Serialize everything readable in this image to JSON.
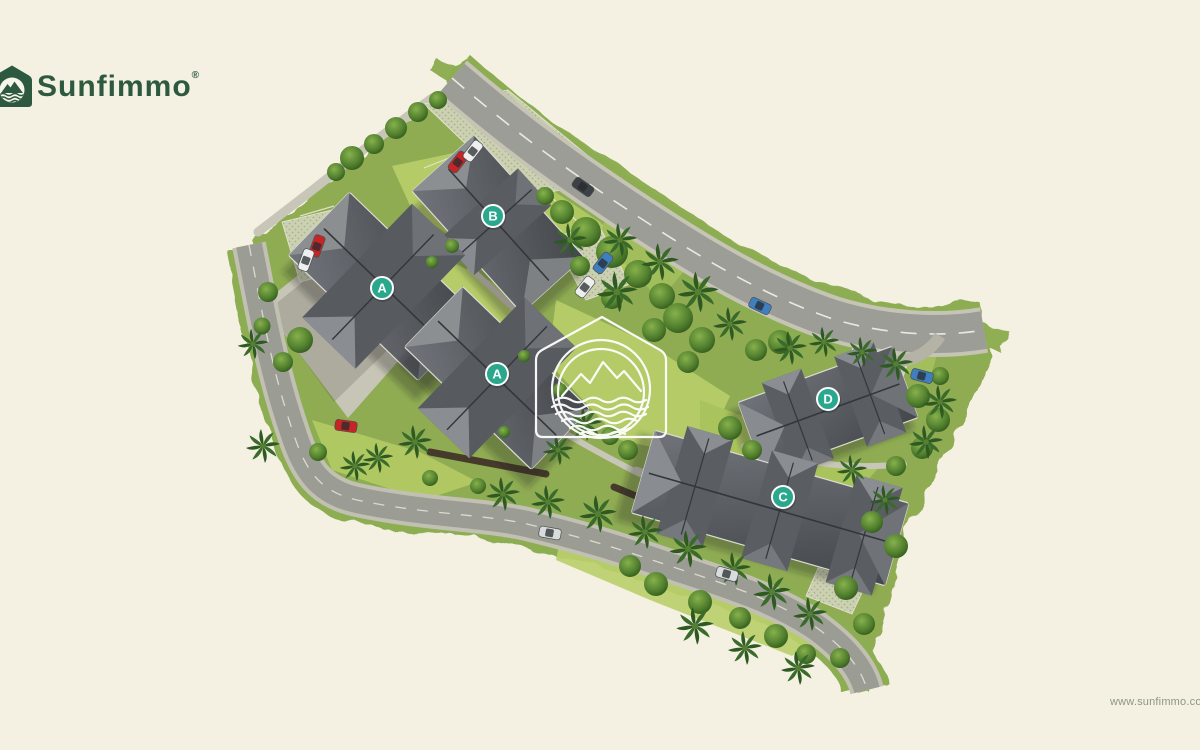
{
  "page": {
    "background_color": "#f4f1e2",
    "width": 1200,
    "height": 750
  },
  "brand": {
    "name": "Sunfimmo",
    "registered_mark": "®",
    "color": "#2d5941",
    "icon": "house-mountains-waves-icon"
  },
  "plan": {
    "kind": "residential masterplan aerial view",
    "watermark_icon": "house-mountains-waves-outline-icon",
    "marker_color": "#2aa88e",
    "building_markers": [
      {
        "label": "A"
      },
      {
        "label": "B"
      },
      {
        "label": "A"
      },
      {
        "label": "C"
      },
      {
        "label": "D"
      }
    ],
    "palette": {
      "roof": "#54585c",
      "road": "#9b9c95",
      "grass": "#8fac52",
      "lawn": "#b9cf6a",
      "path": "#c8c6b8"
    }
  },
  "footer": {
    "website_url": "www.sunfimmo.com"
  }
}
